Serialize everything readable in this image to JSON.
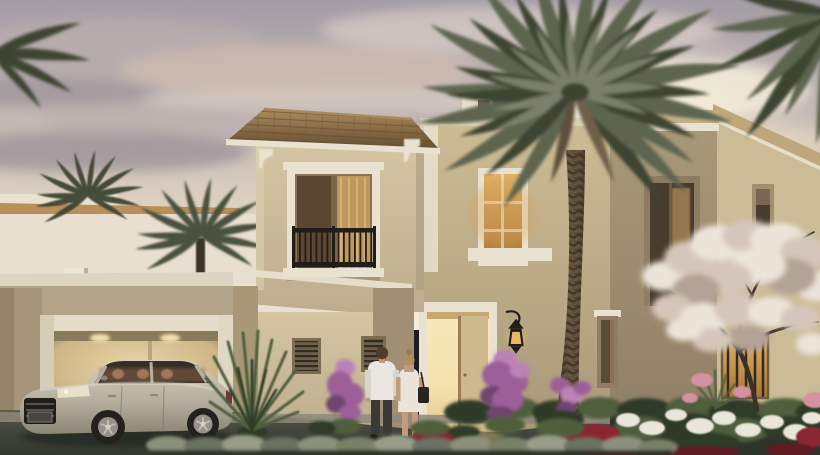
{
  "scene": {
    "title": "Villa exterior rendering at dusk",
    "description": "Twilight architectural rendering of a two-storey Mediterranean-style villa with beige stucco walls, terracotta hip roof, a wrought-iron Juliet balcony, an open double garage with lit interior, a champagne luxury sedan parked on the driveway, a couple walking toward the warmly lit open front door, a tall date palm in front of the facade, a white blossom tree on the right, purple bougainvillea and white, pink and red flower beds, background palms and a neighbouring cream building under a pink-grey cloudy sky.",
    "time_of_day": "dusk",
    "villa": {
      "style": "Mediterranean",
      "storeys": 2,
      "features": [
        "terracotta tile hip roof",
        "white decorative corbels",
        "Juliet balcony with dark wrought-iron railing",
        "white window and door trim",
        "open double garage with warm interior light",
        "open front door with warm light",
        "amber-lit stair-tower window",
        "two black wall lanterns",
        "louvered vents",
        "stepped white parapet copings"
      ]
    },
    "vehicle": {
      "type": "luxury sedan",
      "color_name": "champagne silver",
      "position": "parked on driveway in front of garage"
    },
    "people": [
      {
        "role": "man",
        "clothing": "white long-sleeve shirt, dark trousers",
        "action": "walking toward entrance"
      },
      {
        "role": "woman",
        "clothing": "white dress, dark shoulder bag",
        "action": "walking toward entrance"
      }
    ],
    "vegetation": [
      "large date palm",
      "background palm trees",
      "white blossom tree",
      "purple bougainvillea shrubs",
      "white and pink flower beds",
      "red ground flowers",
      "spiky yucca plants",
      "low grey-green hedge row"
    ],
    "foreground": "dark asphalt driveway with light concrete apron and low hedge",
    "background": "neighbouring cream building with tan coping under a pink-grey cloudy sky with a warm glow at centre-right"
  },
  "colors": {
    "sky_top": "#a29ca5",
    "sky_mid": "#c6bab5",
    "sky_low": "#e7dac8",
    "sky_glow": "#f6eedb",
    "cloud_dark": "#958c94",
    "cloud_mid": "#b9adad",
    "cloud_light": "#ded3c9",
    "cloud_pink": "#d2bdb1",
    "neighbor_wall": "#e9dfd1",
    "neighbor_coping": "#b98f5a",
    "trim_white": "#e9e2d0",
    "wall_light": "#d4c6a2",
    "wall_mid": "#bead8e",
    "wall_dark": "#a3937a",
    "wall_shadow": "#8f7f66",
    "roof_tile": "#8a6c47",
    "roof_tile_dark": "#63502f",
    "roof_edge": "#ab8c5e",
    "window_dark": "#473c2d",
    "window_warm": "#c0985e",
    "amber_window": "#d4a055",
    "door_glow": "#f4e2ae",
    "door_panel": "#cdb98d",
    "garage_glow": "#e9d7a8",
    "garage_shadow": "#7c6b50",
    "lantern_black": "#221d18",
    "lantern_glow": "#e7b766",
    "palm_dark": "#3e4433",
    "palm_mid": "#5d6550",
    "palm_light": "#828770",
    "bark_dark": "#3a3129",
    "bark_mid": "#64543f",
    "blossom_light": "#ece4d9",
    "blossom_mid": "#d5c6bb",
    "blossom_shadow": "#b3a296",
    "branch": "#3a302a",
    "green_dark": "#2e3b28",
    "green_mid": "#4f5f3d",
    "green_light": "#7c8a62",
    "hedge_gray": "#8b907c",
    "hedge_dark": "#6a7160",
    "flower_purple": "#9c5e9a",
    "flower_purple_light": "#bb82b8",
    "flower_purple_dark": "#6f4570",
    "flower_white": "#eae7da",
    "flower_pink": "#d492a0",
    "flower_red": "#8a2531",
    "flower_red_dark": "#5f1a22",
    "car_body_light": "#d3cfbf",
    "car_body": "#b4af9f",
    "car_body_dark": "#8a8575",
    "car_glass": "#332e26",
    "car_seat": "#b07c5f",
    "car_tire": "#23211d",
    "car_rim": "#96928a",
    "asphalt": "#45483f",
    "asphalt_light": "#8e887a",
    "ground_dark": "#2f342b",
    "skin": "#c49b7d",
    "shirt": "#eae7e0",
    "trouser": "#3b3936",
    "dress": "#e9e5da",
    "hair_brown": "#503c2b",
    "hair_blond": "#b2905e",
    "bag_black": "#292420"
  }
}
